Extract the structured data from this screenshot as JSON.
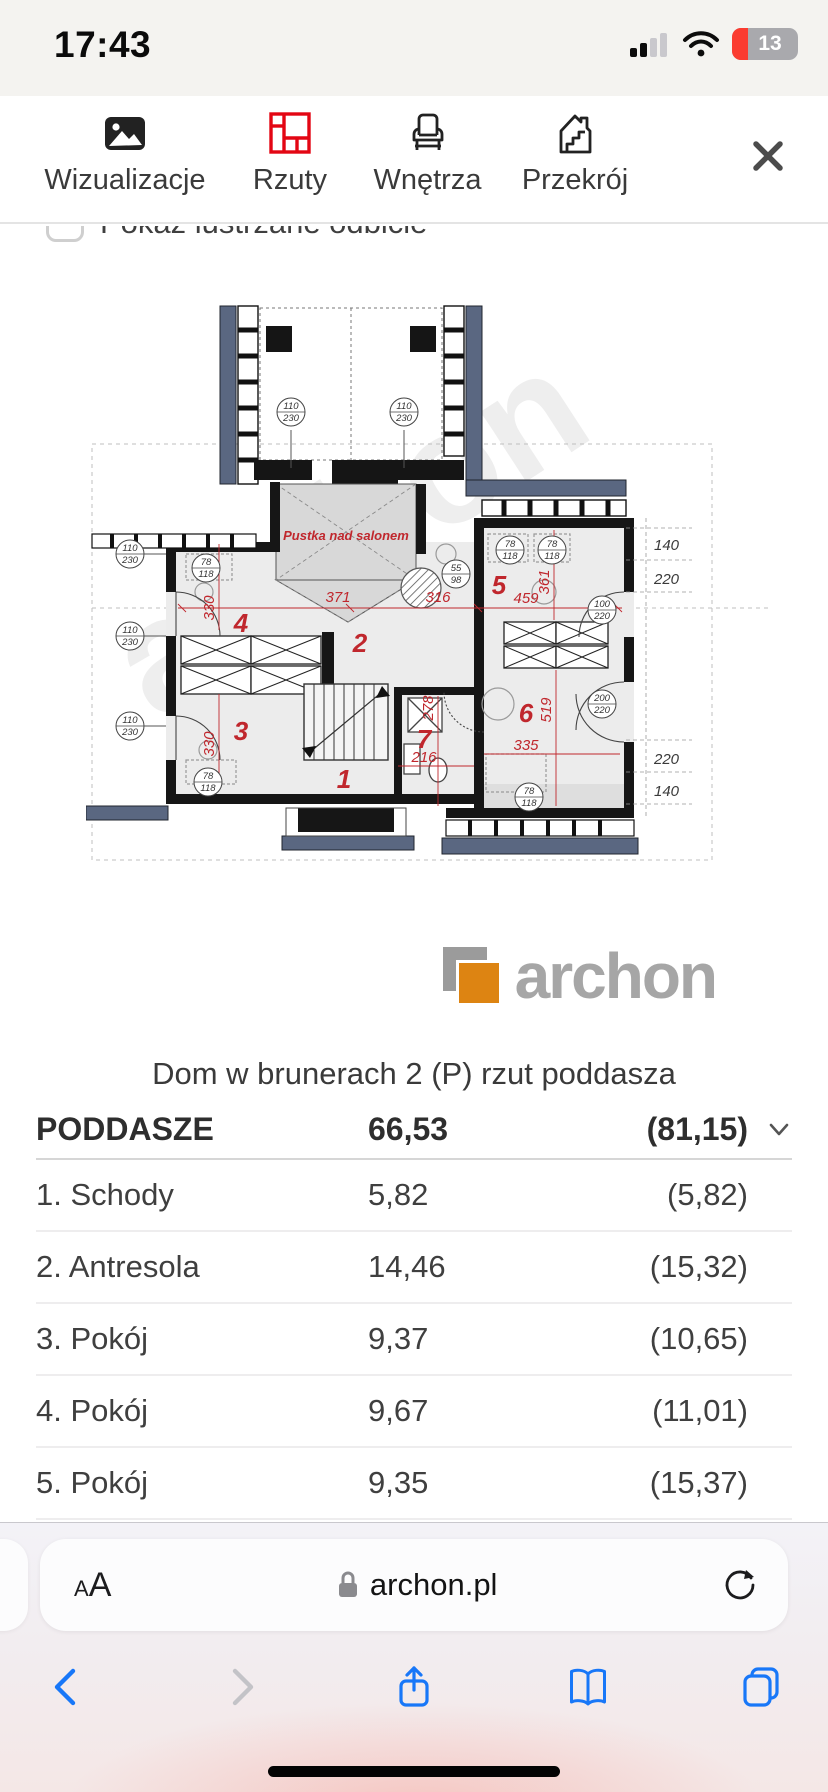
{
  "status_bar": {
    "time": "17:43",
    "battery": "13"
  },
  "nav": {
    "tabs": [
      "Wizualizacje",
      "Rzuty",
      "Wnętrza",
      "Przekrój"
    ],
    "active_tab": "Rzuty",
    "active_color": "#e30613"
  },
  "options": {
    "mirror_label": "Pokaż lustrzane odbicie",
    "checked": false
  },
  "plan": {
    "watermark": "archon",
    "void_label": "Pustka nad salonem",
    "rooms": [
      "1",
      "2",
      "3",
      "4",
      "5",
      "6",
      "7"
    ],
    "dims": [
      "371",
      "330",
      "316",
      "459",
      "361",
      "330",
      "278",
      "216",
      "335",
      "519"
    ],
    "side_dims": [
      "140",
      "220",
      "220",
      "140"
    ],
    "window_tags": [
      {
        "t": "110",
        "b": "230"
      },
      {
        "t": "110",
        "b": "230"
      },
      {
        "t": "78",
        "b": "118"
      },
      {
        "t": "55",
        "b": "98"
      },
      {
        "t": "78",
        "b": "118"
      },
      {
        "t": "78",
        "b": "118"
      },
      {
        "t": "100",
        "b": "220"
      },
      {
        "t": "200",
        "b": "220"
      },
      {
        "t": "110",
        "b": "230"
      },
      {
        "t": "110",
        "b": "230"
      },
      {
        "t": "110",
        "b": "230"
      },
      {
        "t": "78",
        "b": "118"
      },
      {
        "t": "78",
        "b": "118"
      }
    ]
  },
  "logo": {
    "text": "archon",
    "orange": "#dd8412",
    "gray": "#a6a6a6"
  },
  "title": "Dom w brunerach 2 (P) rzut poddasza",
  "table": {
    "header": {
      "name": "PODDASZE",
      "area": "66,53",
      "gross": "(81,15)"
    },
    "rows": [
      {
        "name": "1. Schody",
        "area": "5,82",
        "gross": "(5,82)"
      },
      {
        "name": "2. Antresola",
        "area": "14,46",
        "gross": "(15,32)"
      },
      {
        "name": "3. Pokój",
        "area": "9,37",
        "gross": "(10,65)"
      },
      {
        "name": "4. Pokój",
        "area": "9,67",
        "gross": "(11,01)"
      },
      {
        "name": "5. Pokój",
        "area": "9,35",
        "gross": "(15,37)"
      }
    ]
  },
  "browser": {
    "reader": "AA",
    "url": "archon.pl"
  }
}
